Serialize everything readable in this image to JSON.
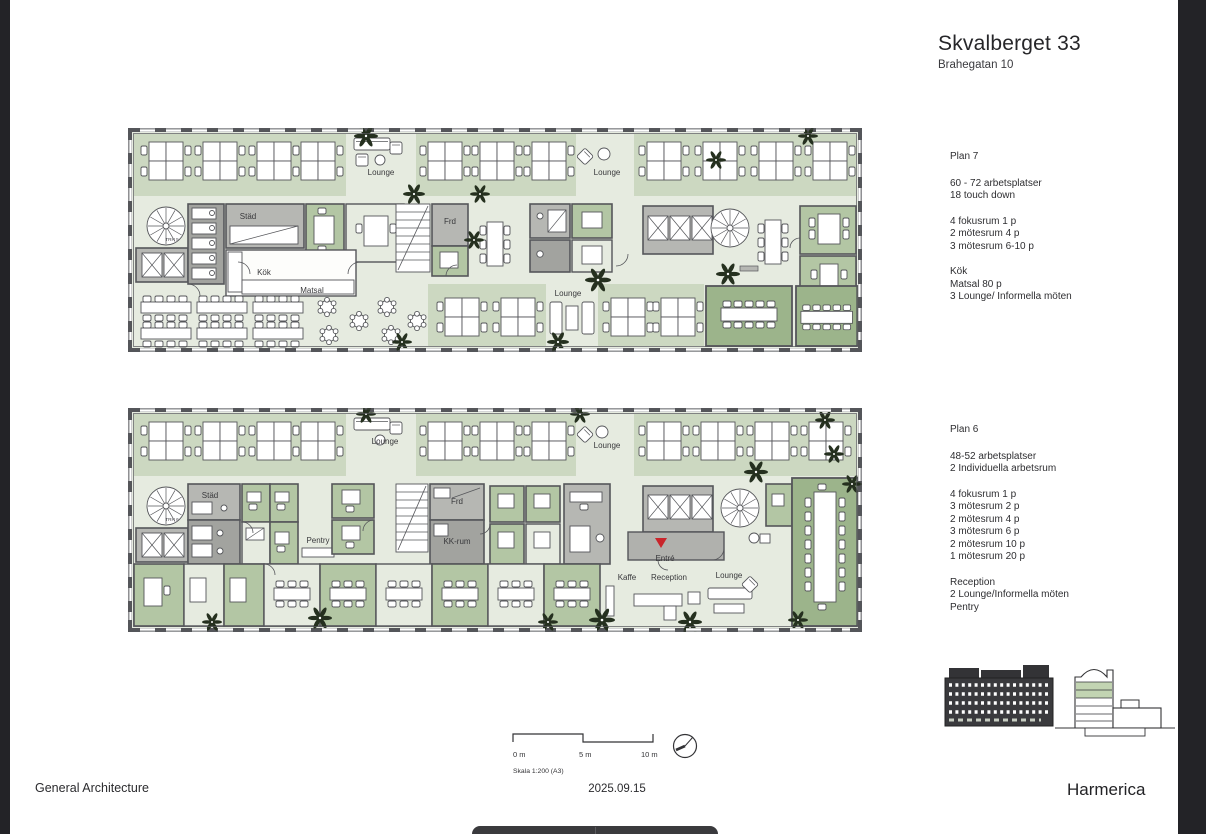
{
  "header": {
    "title": "Skvalberget 33",
    "subtitle": "Brahegatan 10"
  },
  "plan7": {
    "label": "Plan 7",
    "groups": [
      [
        "60 - 72 arbetsplatser",
        "18 touch down"
      ],
      [
        "4 fokusrum 1 p",
        "2 mötesrum 4 p",
        "3 mötesrum 6-10 p"
      ],
      [
        "Kök",
        "Matsal 80 p",
        "3 Lounge/ Informella möten"
      ]
    ],
    "rooms": {
      "lounge_a": "Lounge",
      "lounge_b": "Lounge",
      "lounge_c": "Lounge",
      "stad": "Städ",
      "kok": "Kök",
      "matsal": "Matsal",
      "frd": "Frd",
      "trh": "TRH 5"
    }
  },
  "plan6": {
    "label": "Plan 6",
    "groups": [
      [
        "48-52 arbetsplatser",
        "2 Individuella arbetsrum"
      ],
      [
        "4 fokusrum 1 p",
        "3 mötesrum 2 p",
        "2 mötesrum 4 p",
        "3 mötesrum 6 p",
        "2 mötesrum 10 p",
        "1 mötesrum 20 p"
      ],
      [
        "Reception",
        "2 Lounge/Informella möten",
        "Pentry"
      ]
    ],
    "rooms": {
      "lounge_a": "Lounge",
      "lounge_b": "Lounge",
      "stad": "Städ",
      "pentry": "Pentry",
      "frd": "Frd",
      "kkrum": "KK-rum",
      "entre": "Entré",
      "kaffe": "Kaffe",
      "reception": "Reception",
      "lounge_c": "Lounge",
      "trh": "TRH 6"
    }
  },
  "scale": {
    "t0": "0 m",
    "t5": "5 m",
    "t10": "10 m",
    "label": "Skala 1:200 (A3)"
  },
  "footer": {
    "architect": "General Architecture",
    "date": "2025.09.15",
    "brand": "Harmerica"
  },
  "colors": {
    "room_green": "#b3c6a4",
    "floor_green": "#e6ebe0",
    "wall": "#55565a",
    "entre_marker": "#c9252b"
  }
}
